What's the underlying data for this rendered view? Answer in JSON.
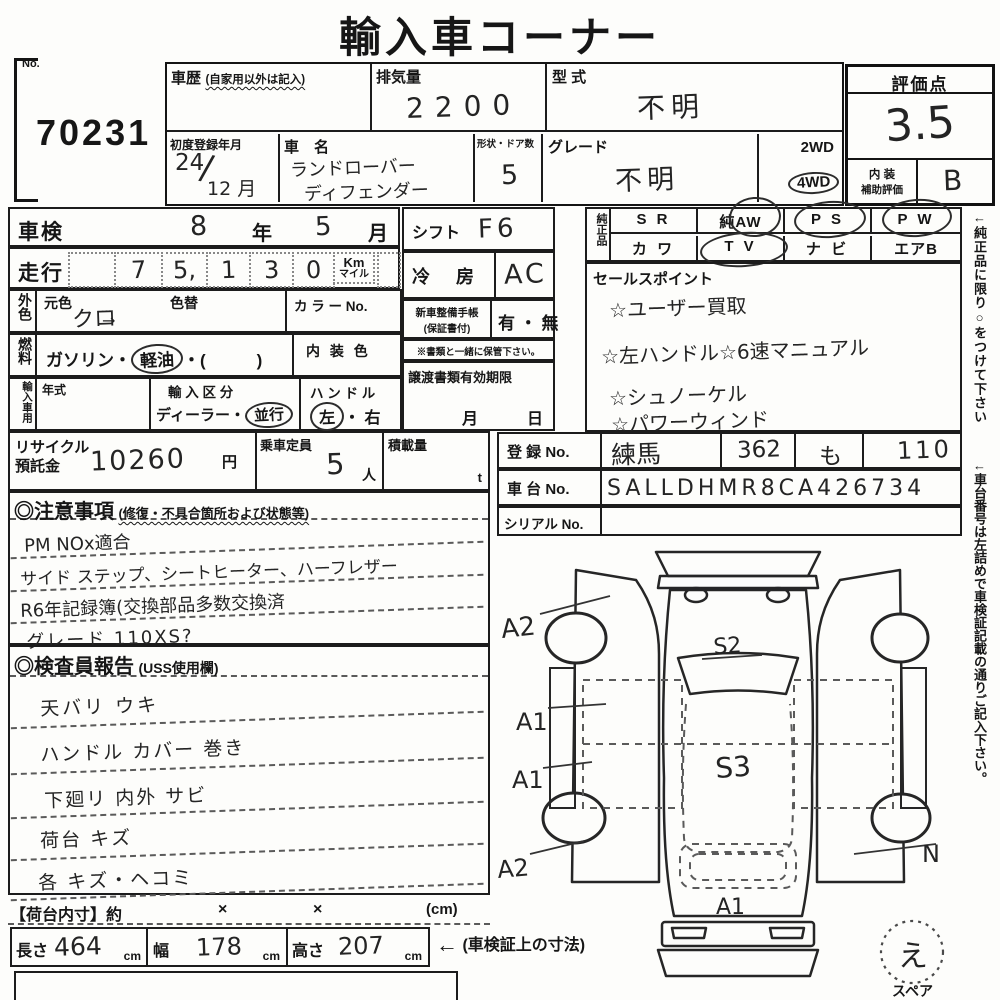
{
  "title": "輸入車コーナー",
  "lot": {
    "label": "No.",
    "number": "70231"
  },
  "header": {
    "history_label": "車歴",
    "history_sub": "(自家用以外は記入)",
    "displacement_label": "排気量",
    "displacement_value": "2200",
    "model_code_label": "型 式",
    "model_code_value": "不明",
    "first_reg_label": "初度登録年月",
    "first_reg_year": "24",
    "first_reg_slash": "/",
    "first_reg_month": "12 月",
    "name_label": "車　名",
    "name_line1": "ランドローバー",
    "name_line2": "ディフェンダー",
    "doors_label": "形状・ドア数",
    "doors_value": "5",
    "grade_label": "グレード",
    "grade_value": "不明",
    "drive_2wd": "2WD",
    "drive_4wd": "4WD"
  },
  "score": {
    "label": "評価点",
    "value": "3.5",
    "interior_label1": "内 装",
    "interior_label2": "補助評価",
    "interior_value": "B"
  },
  "shaken": {
    "label": "車検",
    "year": "8",
    "year_unit": "年",
    "month": "5",
    "month_unit": "月"
  },
  "mileage": {
    "label": "走行",
    "digits": [
      "",
      "7",
      "5,",
      "1",
      "3",
      "0"
    ],
    "unit_km": "Km",
    "unit_mile": "マイル"
  },
  "exterior": {
    "vlabel": "外色",
    "base_label": "元色",
    "base_value": "クロ",
    "arrow": "→",
    "change_label": "色替",
    "color_no_label": "カ ラ ー No."
  },
  "fuel": {
    "vlabel": "燃料",
    "pre": "ガソリン・",
    "circled": "軽油",
    "post": "・(　　　)",
    "interior_color_label": "内 装 色"
  },
  "import_use": {
    "vlabel": "輸入車用",
    "year_label": "年式",
    "class_label": "輸 入 区 分",
    "dealer": "ディーラー",
    "sep": "・",
    "parallel": "並行",
    "handle_label": "ハ ン ド ル",
    "left": "左",
    "dot": "・",
    "right": "右"
  },
  "recycle": {
    "label1": "リサイクル",
    "label2": "預託金",
    "value": "10260",
    "unit": "円",
    "cap_label": "乗車定員",
    "cap_value": "5",
    "cap_unit": "人",
    "load_label": "積載量",
    "load_unit": "t"
  },
  "shift": {
    "label": "シフト",
    "value": "F6"
  },
  "ac": {
    "label": "冷　房",
    "value": "AC"
  },
  "service_book": {
    "label1": "新車整備手帳",
    "label2": "(保証書付)",
    "value": "有 ・ 無",
    "note": "※書類と一緒に保管下さい。"
  },
  "transfer": {
    "label": "譲渡書類有効期限",
    "month": "月",
    "day": "日"
  },
  "oem": {
    "vlabel": "純正品",
    "row1": [
      "S R",
      "純AW",
      "P S",
      "P W"
    ],
    "row2": [
      "カ ワ",
      "T V",
      "ナ ビ",
      "エアB"
    ]
  },
  "sales": {
    "label": "セールスポイント",
    "lines": [
      "☆ユーザー買取",
      "☆左ハンドル☆6速マニュアル",
      "☆シュノーケル",
      "☆パワーウィンド"
    ]
  },
  "registration": {
    "reg_label": "登 録 No.",
    "area": "練馬",
    "class_no": "362",
    "kana": "も",
    "number": "110",
    "vin_label": "車 台 No.",
    "vin": "SALLDHMR8CA426734",
    "serial_label": "シリアル No."
  },
  "notes": {
    "title": "◎注意事項",
    "subtitle": "(修復・不具合箇所および状態等)",
    "lines": [
      "PM NOx適合",
      "サイド ステップ、シートヒーター、ハーフレザー",
      "R6年記録簿(交換部品多数交換済",
      "グレード 110XS?"
    ]
  },
  "report": {
    "title": "◎検査員報告",
    "subtitle": "(USS使用欄)",
    "lines": [
      "天バリ ウキ",
      "ハンドル カバー 巻き",
      "下廻リ 内外 サビ",
      "荷台 キズ",
      "各 キズ・ヘコミ"
    ]
  },
  "cargo": {
    "label": "【荷台内寸】約",
    "x1": "×",
    "x2": "×",
    "unit": "(cm)",
    "len_label": "長さ",
    "len_value": "464",
    "len_unit": "cm",
    "wid_label": "幅",
    "wid_value": "178",
    "wid_unit": "cm",
    "hei_label": "高さ",
    "hei_value": "207",
    "hei_unit": "cm",
    "note_arrow": "←",
    "note": "(車検証上の寸法)"
  },
  "diagram": {
    "s2": "S2",
    "s3": "S3",
    "a2_front": "A2",
    "a1_mid1": "A1",
    "a1_mid2": "A1",
    "a2_rear": "A2",
    "a1_rear": "A1",
    "n_mark": "N",
    "spare_mark": "え",
    "spare_label": "スペア"
  },
  "side_notes": {
    "note1": "←純正品に限り○をつけて下さい",
    "note2": "←車台番号は左詰めで車検証記載の通りご記入下さい。"
  }
}
